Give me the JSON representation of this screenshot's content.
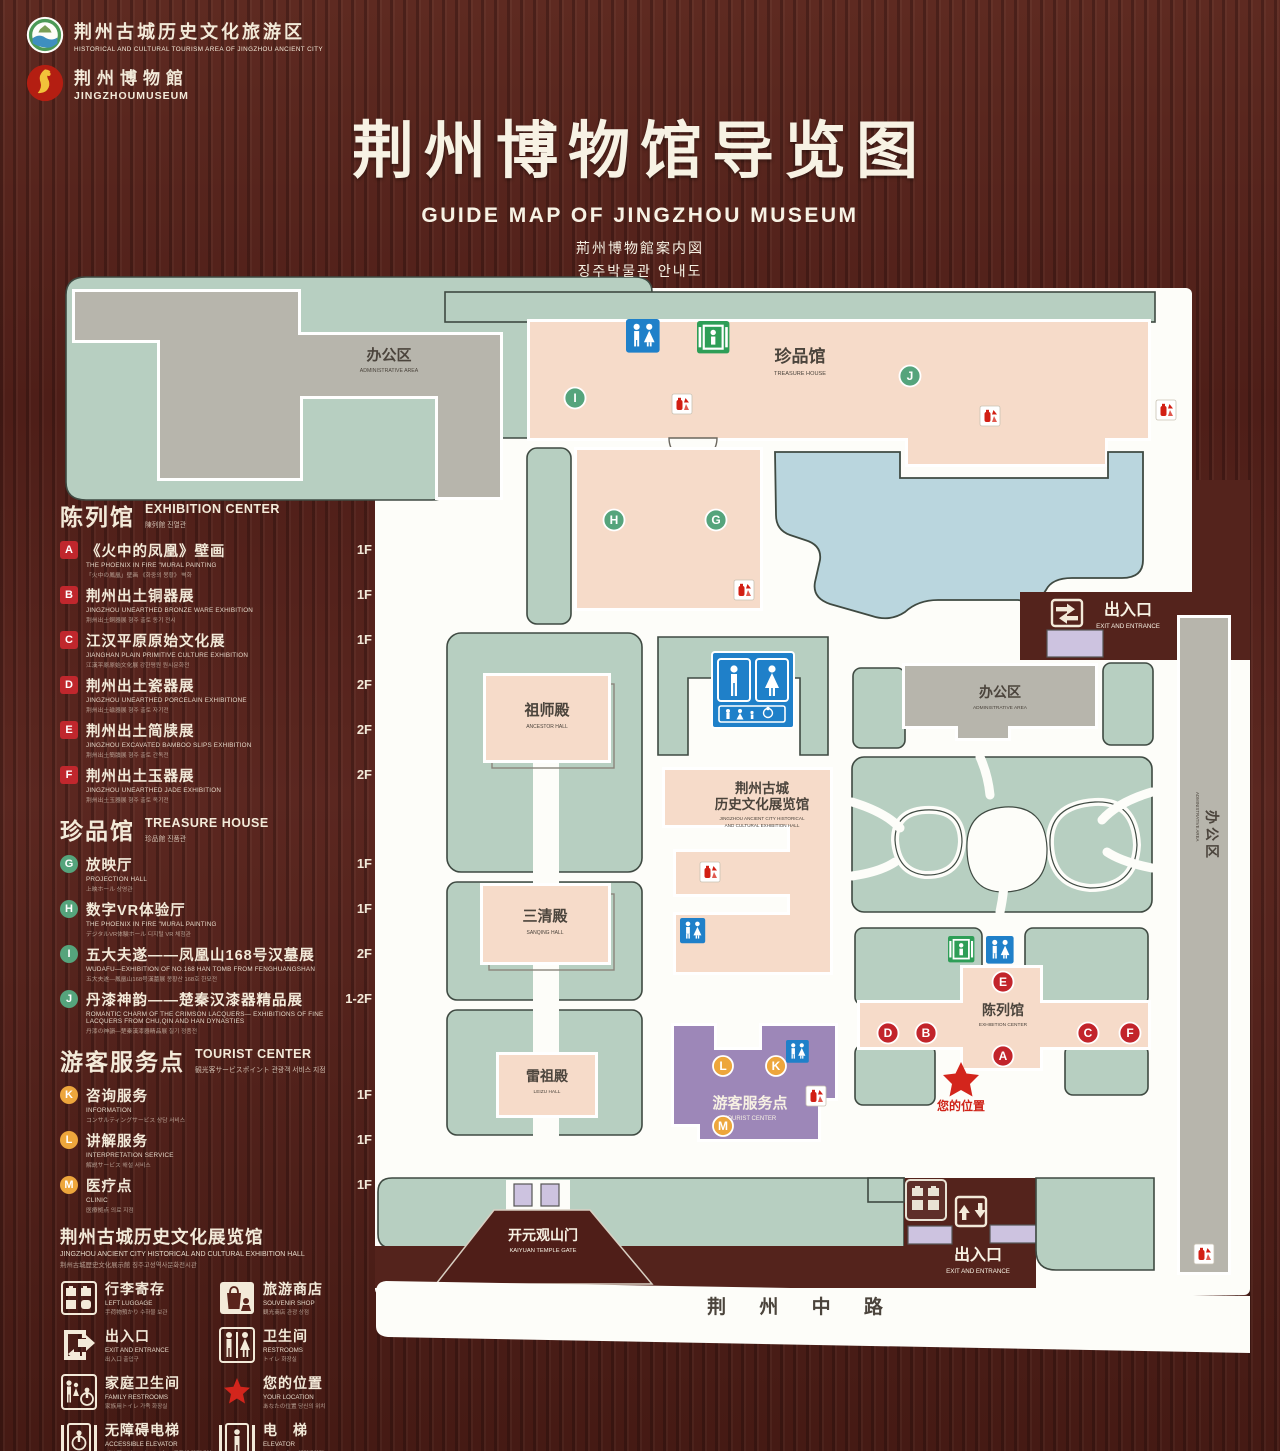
{
  "header": {
    "logo1": {
      "cn": "荆州古城历史文化旅游区",
      "en": "HISTORICAL AND CULTURAL TOURISM AREA OF JINGZHOU ANCIENT CITY"
    },
    "logo2": {
      "cn": "荆州博物館",
      "en": "JINGZHOUMUSEUM"
    },
    "title": "荆州博物馆导览图",
    "subtitle_en": "GUIDE MAP OF JINGZHOU MUSEUM",
    "subtitle_jp": "荊州博物館案内図",
    "subtitle_kr": "징주박물관 안내도"
  },
  "legend": {
    "exhibition": {
      "heading": "陈列馆",
      "heading_en": "EXHIBITION CENTER",
      "heading_sub": "陳列館  진열관",
      "items": [
        {
          "key": "A",
          "label": "《火中的凤凰》壁画",
          "en": "THE PHOENIX IN FIRE \"MURAL PAINTING",
          "sub": "「火中の鳳凰」壁画 《화중의 봉황》 벽화",
          "floor": "1F"
        },
        {
          "key": "B",
          "label": "荆州出土铜器展",
          "en": "JINGZHOU UNEARTHED BRONZE WARE EXHIBITION",
          "sub": "荆州出土銅器展  형주 출토 동기 전시",
          "floor": "1F"
        },
        {
          "key": "C",
          "label": "江汉平原原始文化展",
          "en": "JIANGHAN PLAIN PRIMITIVE CULTURE EXHIBITION",
          "sub": "江漢平原原始文化展  강한평원 원시문화전",
          "floor": "1F"
        },
        {
          "key": "D",
          "label": "荆州出土瓷器展",
          "en": "JINGZHOU UNEARTHED PORCELAIN EXHIBITIONE",
          "sub": "荆州出土磁器展  형주 출토 자기전",
          "floor": "2F"
        },
        {
          "key": "E",
          "label": "荆州出土简牍展",
          "en": "JINGZHOU EXCAVATED BAMBOO SLIPS EXHIBITION",
          "sub": "荆州出土簡牘展  형주 출토 간독전",
          "floor": "2F"
        },
        {
          "key": "F",
          "label": "荆州出土玉器展",
          "en": "JINGZHOU UNEARTHED JADE EXHIBITION",
          "sub": "荆州出土玉器展  형주 출토 옥기전",
          "floor": "2F"
        }
      ]
    },
    "treasure": {
      "heading": "珍品馆",
      "heading_en": "TREASURE HOUSE",
      "heading_sub": "珍品館  진품관",
      "items": [
        {
          "key": "G",
          "label": "放映厅",
          "en": "PROJECTION HALL",
          "sub": "上映ホール  상영관",
          "floor": "1F"
        },
        {
          "key": "H",
          "label": "数字VR体验厅",
          "en": "THE PHOENIX IN FIRE \"MURAL PAINTING",
          "sub": "デジタルVR体験ホール  디지털 VR 체험관",
          "floor": "1F"
        },
        {
          "key": "I",
          "label": "五大夫遂——凤凰山168号汉墓展",
          "en": "WUDAFU—EXHIBITION OF NO.168 HAN TOMB FROM FENGHUANGSHAN",
          "sub": "五大夫遂—鳳凰山168号漢墓展  봉황산 168호 한묘전",
          "floor": "2F"
        },
        {
          "key": "J",
          "label": "丹漆神韵——楚秦汉漆器精品展",
          "en": "ROMANTIC CHARM OF THE CRIMSON LACQUERS— EXHIBITIONS OF FINE LACQUERS FROM CHU,QIN AND HAN DYNASTIES",
          "sub": "丹漆の神韻—楚秦漢漆器精品展  칠기 정품전",
          "floor": "1-2F"
        }
      ]
    },
    "tourist": {
      "heading": "游客服务点",
      "heading_en": "TOURIST CENTER",
      "heading_sub": "観光客サービスポイント  관광객 서비스 지점",
      "items": [
        {
          "key": "K",
          "label": "咨询服务",
          "en": "INFORMATION",
          "sub": "コンサルティングサービス  상담 서비스",
          "floor": "1F"
        },
        {
          "key": "L",
          "label": "讲解服务",
          "en": "INTERPRETATION SERVICE",
          "sub": "解説サービス  해설 서비스",
          "floor": "1F"
        },
        {
          "key": "M",
          "label": "医疗点",
          "en": "CLINIC",
          "sub": "医療拠点  의료 지점",
          "floor": "1F"
        }
      ]
    },
    "hall_note": {
      "label": "荆州古城历史文化展览馆",
      "en": "JINGZHOU ANCIENT CITY HISTORICAL AND CULTURAL EXHIBITION HALL",
      "sub": "荆州古城歴史文化展示館   징주고성역사문화전시관"
    },
    "icons": [
      {
        "name": "left-luggage",
        "label": "行李寄存",
        "en": "LEFT LUGGAGE",
        "sub": "手荷物預かり  수하물 보관"
      },
      {
        "name": "souvenir-shop",
        "label": "旅游商店",
        "en": "SOUVENIR SHOP",
        "sub": "観光商店  관광 상점"
      },
      {
        "name": "exit-entrance",
        "label": "出入口",
        "en": "EXIT AND ENTRANCE",
        "sub": "出入口  출입구"
      },
      {
        "name": "restrooms",
        "label": "卫生间",
        "en": "RESTROOMS",
        "sub": "トイレ  화장실"
      },
      {
        "name": "family-restrooms",
        "label": "家庭卫生间",
        "en": "FAMILY RESTROOMS",
        "sub": "家族用トイレ  가족 화장실"
      },
      {
        "name": "your-location",
        "label": "您的位置",
        "en": "YOUR LOCATION",
        "sub": "あなたの位置  당신의 위치"
      },
      {
        "name": "accessible-elevator",
        "label": "无障碍电梯",
        "en": "ACCESSIBLE ELEVATOR",
        "sub": "バリアフリーエレベーター  무장애 엘리베이터"
      },
      {
        "name": "elevator",
        "label": "电　梯",
        "en": "ELEVATOR",
        "sub": "エレベーター  엘리베이터"
      }
    ],
    "areas": [
      {
        "label": "展示区域",
        "en": "DISPLAY AREA",
        "sub": "展示エリア  전시 영역",
        "color": "#f6dbc9"
      },
      {
        "label": "办公区域",
        "en": "OFFICE AREA",
        "sub": "オフィスエリア  사무 영역",
        "color": "#b9b7ae"
      }
    ]
  },
  "map": {
    "admin_nw": {
      "cn": "办公区",
      "en": "ADMINISTRATIVE AREA"
    },
    "treasure": {
      "cn": "珍品馆",
      "en": "TREASURE HOUSE"
    },
    "ancestor": {
      "cn": "祖师殿",
      "en": "ANCESTOR HALL"
    },
    "sanqing": {
      "cn": "三清殿",
      "en": "SANQING HALL"
    },
    "leizu": {
      "cn": "雷祖殿",
      "en": "LEIZU HALL"
    },
    "history": {
      "cn1": "荆州古城",
      "cn2": "历史文化展览馆",
      "en1": "JINGZHOU ANCIENT CITY HISTORICAL",
      "en2": "AND CULTURAL EXHIBITION HALL"
    },
    "admin_e": {
      "cn": "办公区",
      "en": "ADMINISTRATIVE AREA"
    },
    "admin_strip": {
      "cn": "办公区",
      "en": "ADMINISTRATIVE AREA"
    },
    "exhibition": {
      "cn": "陈列馆",
      "en": "EXHIBITION CENTER"
    },
    "tourist": {
      "cn": "游客服务点",
      "en": "TOURIST CENTER"
    },
    "gate": {
      "cn": "开元观山门",
      "en": "KAIYUAN TEMPLE GATE"
    },
    "exit_tr": {
      "cn": "出入口",
      "en": "EXIT AND ENTRANCE"
    },
    "exit_b": {
      "cn": "出入口",
      "en": "EXIT AND ENTRANCE"
    },
    "road": {
      "cn": "荆 州 中 路"
    },
    "your_location": "您的位置",
    "markers": {
      "A": "A",
      "B": "B",
      "C": "C",
      "D": "D",
      "E": "E",
      "F": "F",
      "G": "G",
      "H": "H",
      "I": "I",
      "J": "J",
      "K": "K",
      "L": "L",
      "M": "M"
    }
  }
}
